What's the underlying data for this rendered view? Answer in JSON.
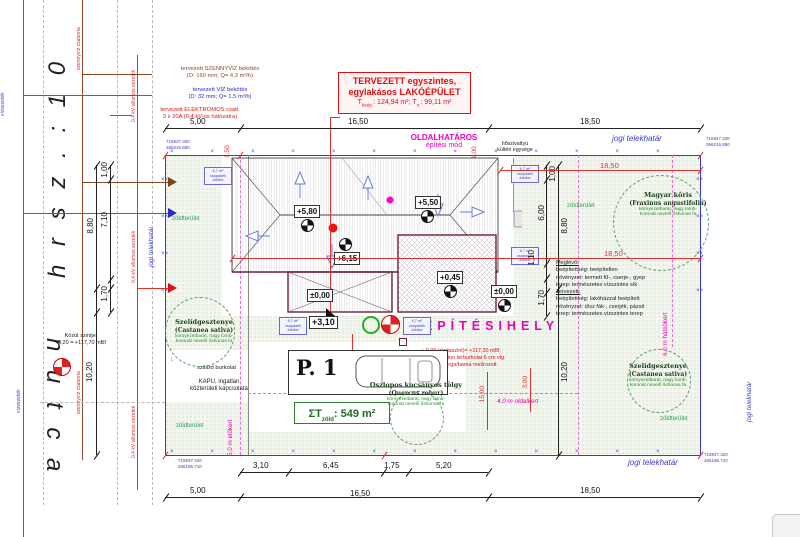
{
  "symbols": {
    "marks_h": "×××××××××××××",
    "marks_v": "××××××××",
    "gate_arrow": "↓"
  },
  "margin": {
    "hrsz": "h r s z . :   1 0",
    "street": "n   u t c a",
    "viz": "vízvezeték",
    "szennyviz": "szennyvíz csatorna",
    "villamos": "0,4 kV villamos vezeték",
    "kozut1": "Közút szintje:",
    "kozut2": "-0,20 = +117,70 mBf"
  },
  "utilities": {
    "u1a": "tervezett SZENNYVÍZ bekötés",
    "u1b": "(D: 160 mm; Q= 4,3 m³/h)",
    "u2a": "tervezett VÍZ bekötés",
    "u2b": "(D: 32 mm; Q= 1,5 m³/h)",
    "u3a": "tervezett ELEKTROMOS csatl.",
    "u3b": "3 x 20A (0,4 kV-os hálózatra)"
  },
  "title": {
    "l1": "TERVEZETT egyszintes,",
    "l2": "egylakásos LAKÓÉPÜLET",
    "a1": "T",
    "a1s": "beép.",
    "a1v": ": 124,94 m²; ",
    "a2": "T",
    "a2s": "n.",
    "a2v": ": 99,11 m²"
  },
  "zones": {
    "oldal1": "OLDALHATÁROS",
    "oldal2": "építési mód",
    "hoszi1": "hőszivattyú",
    "hoszi2": "kültéri egysége",
    "epitesihely": "ÉPÍTÉSIHELY",
    "elokert": "5,0 m előkert",
    "oldalkert": "4,0 m oldalkert",
    "hatsokert": "6,0 m hátsókert",
    "jogi": "jogi telekhatár",
    "zold": "zöldterület"
  },
  "levels": {
    "v580": "+5,80",
    "v550": "+5,50",
    "v615": "+6,15",
    "v045": "+0,45",
    "v000": "±0,00",
    "v310": "+3,10"
  },
  "dims": {
    "d500": "5,00",
    "d1650": "16,50",
    "d1850": "18,50",
    "d310": "3,10",
    "d645": "6,45",
    "d175": "1,75",
    "d520": "5,20",
    "d100": "1,00",
    "d710": "7,10",
    "d880": "8,80",
    "d170": "1,70",
    "d1020": "10,20",
    "d600": "6,00",
    "d110": "1,10",
    "d150": "1,50",
    "d1500": "15,00",
    "d300": "3,00"
  },
  "coords": {
    "tl1": "715937.320",
    "tl2": "266216.850",
    "tr1": "715947.320",
    "tr2": "266216.850",
    "bl1": "715937.320",
    "bl2": "266196.710",
    "br1": "715947.320",
    "br2": "266196.710"
  },
  "notes": {
    "jarda1": "+-0,00 (járdaszint)= +117,30 mBf,",
    "jarda2": "kiselemes beton térburkolat 6 cm vtg.",
    "jarda3": "szürke/sárga/barna melírozott",
    "kapu1": "KAPU, ingatlan",
    "kapu2": "közterületi kapcsolata",
    "szilard": "szilárd burkolat"
  },
  "site_state": {
    "h1": "Meglévő:",
    "l1": "beépítettség: beépítetlen",
    "l2": "növényzet: termett fű-, cserje-, gyep",
    "l3": "terep: természetes vízszintes sík",
    "h2": "Tervezett:",
    "l4": "beépítettség: lakóházzal beépített",
    "l5": "növényzet: dísz fák-, cserjék, pázsit",
    "l6": "terep: természetes vízszintes terep"
  },
  "trees": {
    "t1n": "Magyar kőris",
    "t1l": "(Fraxinus angustifolia)",
    "t2n": "Szelídgesztenye",
    "t2l": "(Castanea sativa)",
    "t3n": "Oszlopos kocsányos tölgy",
    "t3l": "(Quercus robur)",
    "desc1": "környezetbarát, nagy lomb-",
    "desc2": "koronát nevelő őshonos fa"
  },
  "parking": {
    "p1": "P. 1"
  },
  "green_total": {
    "sig": "ΣT",
    "sub": "zöld",
    "val": ": 549 m²"
  },
  "rain_box": {
    "r1": "6,7 m²",
    "r2": "csapadék",
    "r3": "zöldbe"
  },
  "colors": {
    "boundary": "#3a3ad0",
    "magenta": "#ee00bb",
    "red": "#e00000",
    "green": "#2e9e4f",
    "maroon": "#6b1f3f",
    "brown": "#8a4a20"
  }
}
